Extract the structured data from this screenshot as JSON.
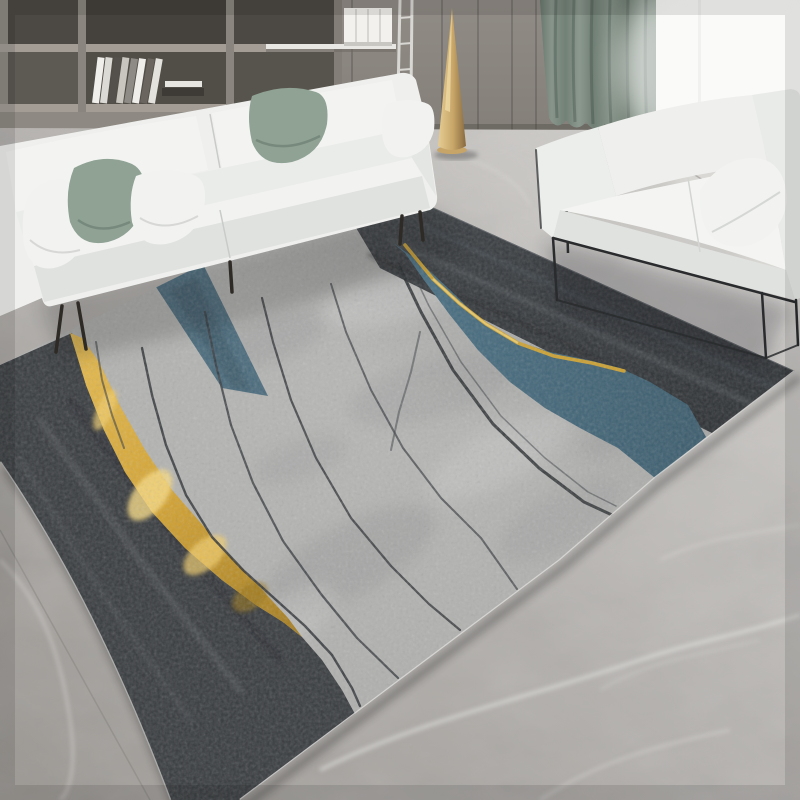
{
  "scene": {
    "description": "Bright modern living room: white three-seat sofa with sage and white pillows in front of wood wall shelving with books, a white two-seat sofa on a black metal frame by a bright window with a sage green curtain, a gold cone floor lamp, and a large gray abstract area rug with charcoal bands, teal streams and gold ribbons lying on a gray marble tile floor.",
    "room": "living room",
    "style": "rug product photograph"
  },
  "objects": {
    "rug": "gray abstract rug with charcoal edge bands, two teal streams, curved gold ribbon and thin dark accent lines",
    "sofa": "white three-seat fabric sofa",
    "loveseat": "white two-seat sofa with thin black metal frame",
    "pillows": [
      "white corner pillow",
      "sage green pillow",
      "white pillow",
      "sage green pillow",
      "white pillow",
      "white loveseat pillow"
    ],
    "floor_lamp": "tall gold cone floor lamp",
    "shelving": "gray wood wall shelving with books and white book stack",
    "ladder": "thin white wall ladder rails",
    "curtain": "sage green floor curtain",
    "window": "bright overexposed window",
    "floor": "gray marble tile floor with white veins"
  },
  "palette": {
    "wall_wood": "#8b8680",
    "shelf_cavity": "#4c4843",
    "curtain_green": "#7d8b80",
    "window_white": "#f4f5f2",
    "marble_base": "#b1aeab",
    "sofa_white": "#eff0ee",
    "pillow_green": "#8fa294",
    "pillow_white": "#f2f3f1",
    "rug_field": "#b2b2b0",
    "rug_charcoal": "#3d4043",
    "rug_teal": "#4b7184",
    "rug_teal_left": "#4d6d7e",
    "rug_gold": "#d2a335",
    "gold_line": "#d9ac38",
    "lamp_gold": "#c7a568",
    "frame_black": "#292b2d"
  }
}
